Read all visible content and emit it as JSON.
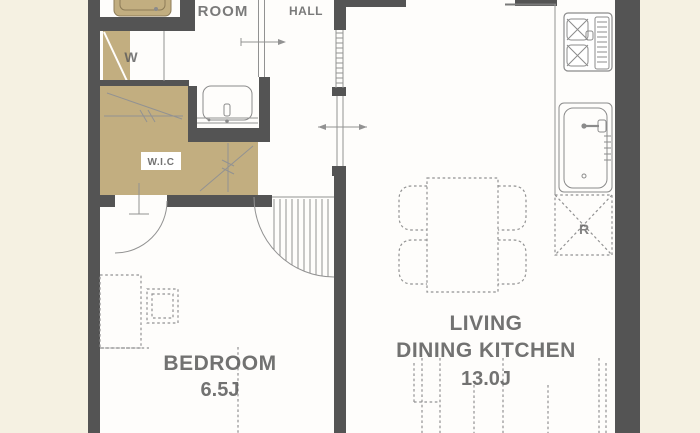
{
  "colors": {
    "background": "#f5f1e2",
    "floor": "#fefdfb",
    "wall": "#545454",
    "tan": "#c2ae80",
    "line": "#929292",
    "text": "#5a5a5a"
  },
  "labels": {
    "room": "ROOM",
    "hall": "HALL",
    "washer": "W",
    "walk_in_closet": "W.I.C",
    "bedroom_name": "BEDROOM",
    "bedroom_size": "6.5J",
    "ldk_line1": "LIVING",
    "ldk_line2": "DINING KITCHEN",
    "ldk_size": "13.0J",
    "refrigerator": "R"
  }
}
